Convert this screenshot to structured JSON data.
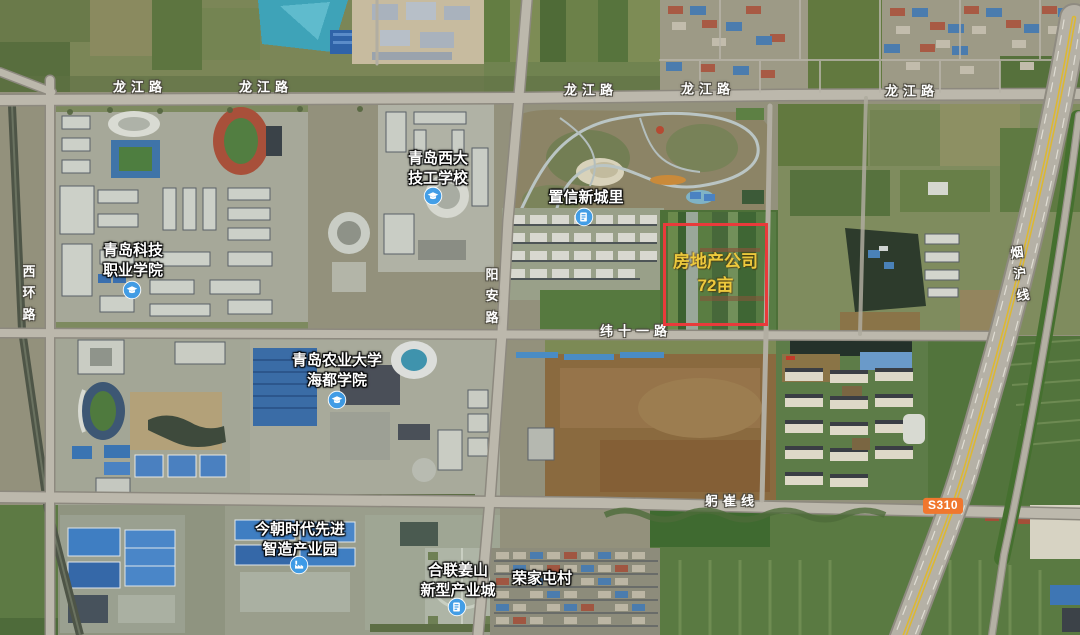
{
  "map": {
    "roads": {
      "longjiang": "龙江路",
      "xihuan": "西环路",
      "yangan": "阳安路",
      "weishiyi": "纬十一路",
      "gongcui": "躬崔线",
      "yanhu": "烟沪线"
    },
    "route_badge": "S310",
    "annotation": {
      "line1": "房地产公司",
      "line2": "72亩"
    },
    "pois": [
      {
        "name": "青岛西大技工学校",
        "line1": "青岛西大",
        "line2": "技工学校",
        "icon": "school"
      },
      {
        "name": "置信新城里",
        "line1": "置信新城里",
        "line2": "",
        "icon": "community"
      },
      {
        "name": "青岛科技职业学院",
        "line1": "青岛科技",
        "line2": "职业学院",
        "icon": "school"
      },
      {
        "name": "青岛农业大学海都学院",
        "line1": "青岛农业大学",
        "line2": "海都学院",
        "icon": "school"
      },
      {
        "name": "今朝时代先进智造产业园",
        "line1": "今朝时代先进",
        "line2": "智造产业园",
        "icon": "factory"
      },
      {
        "name": "合联姜山新型产业城",
        "line1": "合联姜山",
        "line2": "新型产业城",
        "icon": "community"
      },
      {
        "name": "荣家屯村",
        "line1": "荣家屯村",
        "line2": "",
        "icon": ""
      }
    ],
    "colors": {
      "annotation_border": "#e93a3b",
      "annotation_text": "#edc93d",
      "route_badge_bg": "#f0772e",
      "poi_icon_blue": "#3d9ce9",
      "highway_yellow": "#ddb832"
    }
  }
}
